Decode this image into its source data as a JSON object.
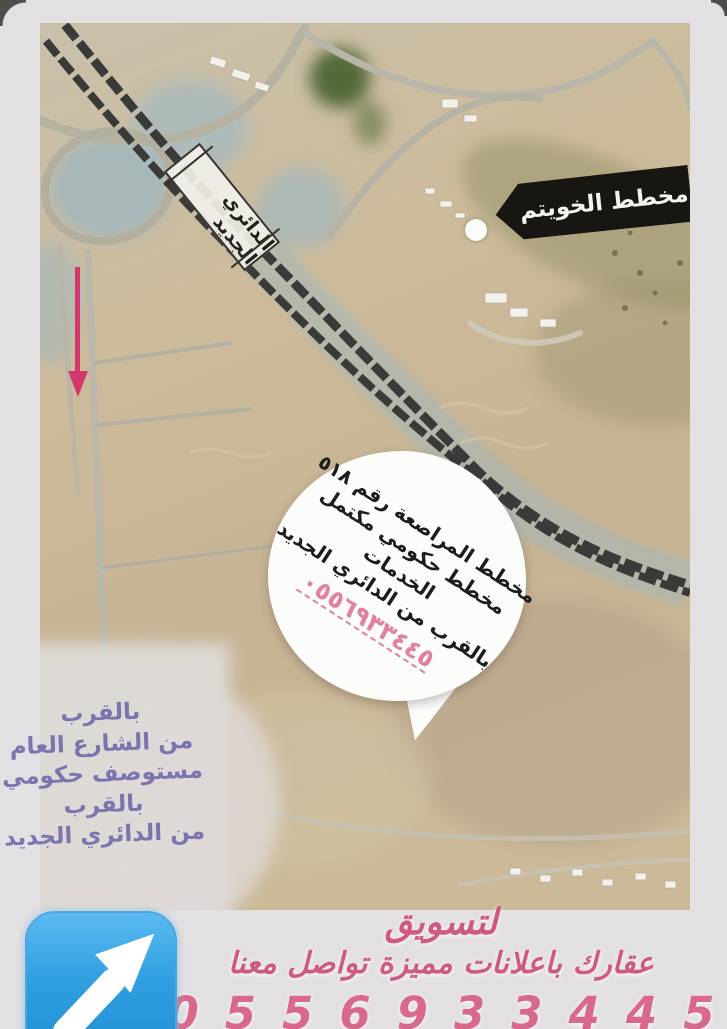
{
  "map": {
    "area_tag": "مخطط الخويتم",
    "road_label": "الدائري الجديد",
    "bubble": {
      "lines": [
        "مخطط المراصعة رقم ٥١٨",
        "مخطط حكومي مكتمل",
        "الخدمات",
        "بالقرب من الدائري الجديد"
      ],
      "phone": "٠٥٥٦٩٣٣٤٤٥"
    },
    "side_note": {
      "lines": [
        "بالقرب",
        "من الشارع العام",
        "مستوصف حكومي",
        "بالقرب",
        "من الدائري الجديد"
      ]
    }
  },
  "footer": {
    "line1": "لتسويق",
    "line2": "عقارك باعلانات مميزة تواصل معنا",
    "phone": "0556933445",
    "icon": "up-right-arrow"
  },
  "colors": {
    "background": "#e2e0e3",
    "annotation_pink": "#d2386e",
    "note_violet": "#7b74ae",
    "footer_pink": "#cf5a80",
    "tag_black": "#181613",
    "bubble_phone_pink": "#e2809f",
    "icon_blue": "#2f9fe0"
  }
}
